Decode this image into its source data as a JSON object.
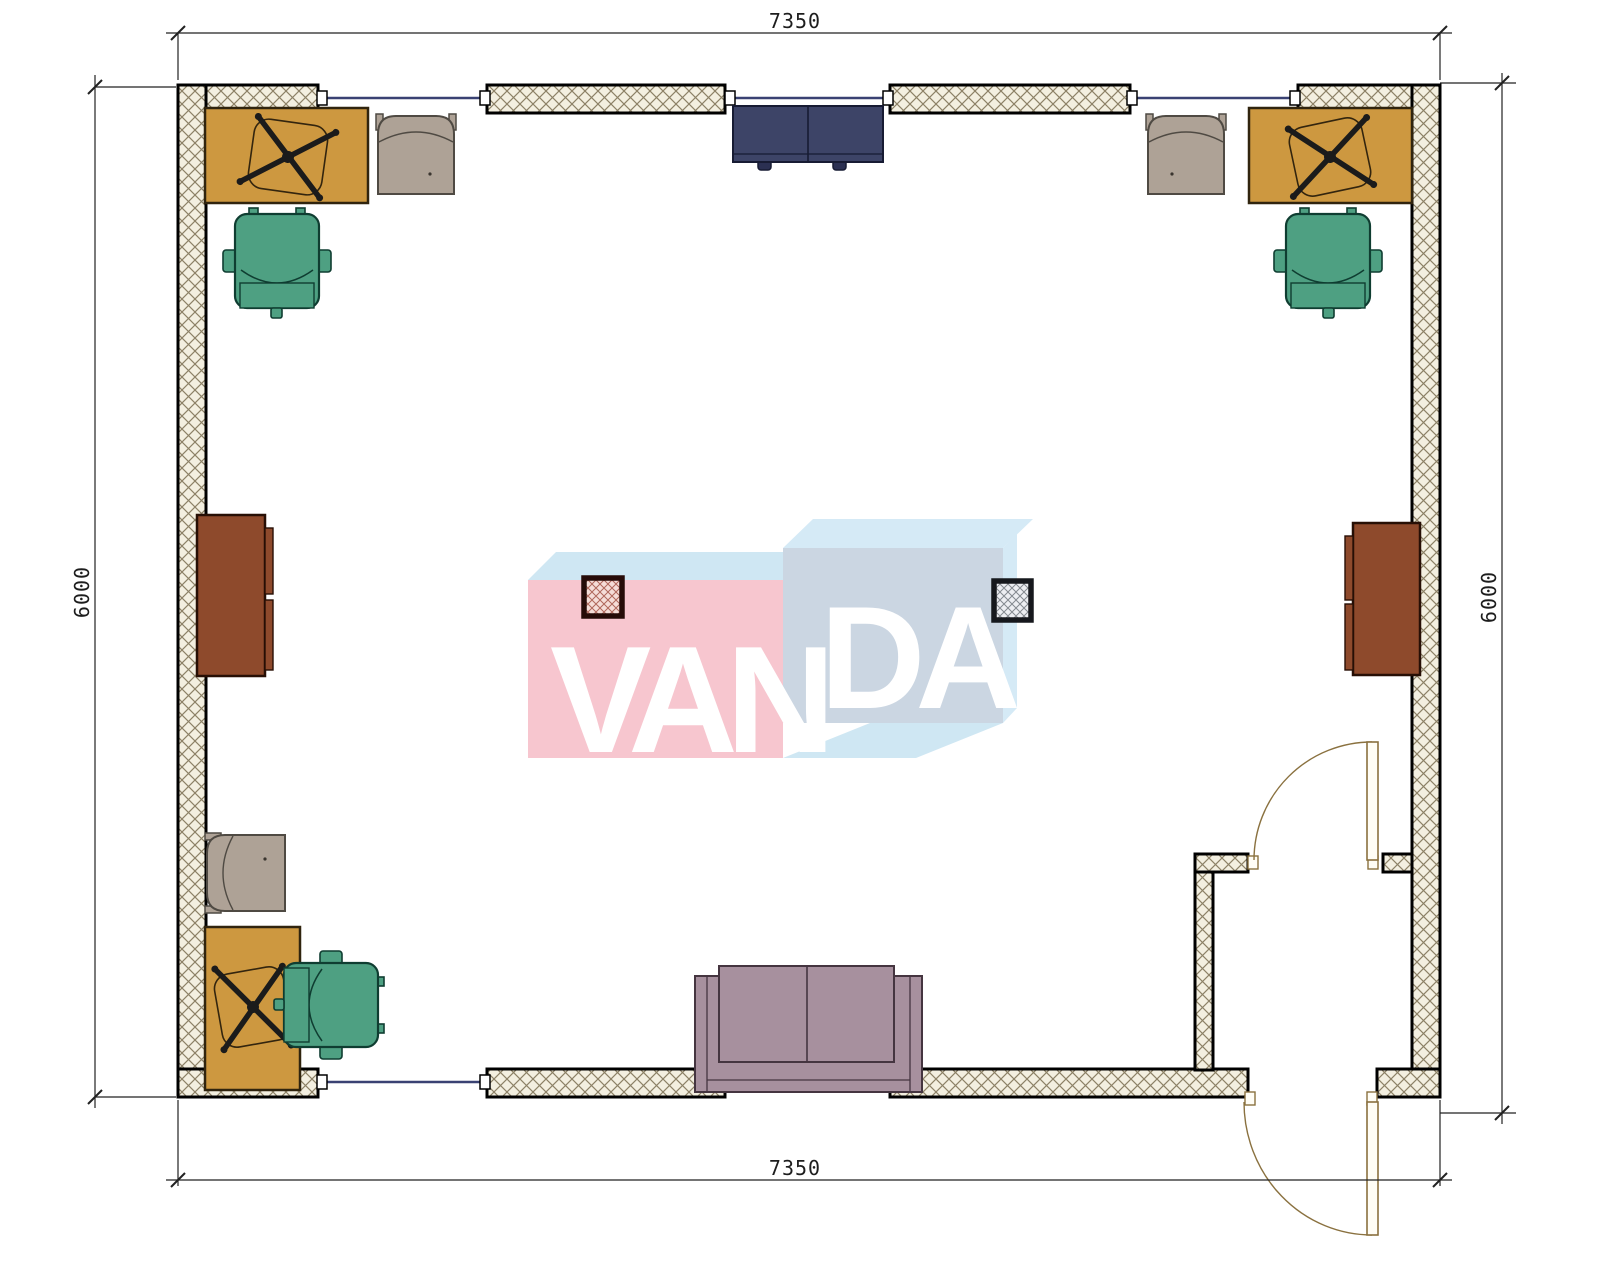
{
  "drawing": {
    "type": "floor-plan",
    "dimensions": {
      "top": "7350",
      "bottom": "7350",
      "left": "6000",
      "right": "6000"
    },
    "logo": {
      "name": "VANDA",
      "van": "VAN",
      "da": "DA"
    },
    "furniture": [
      "desk-top-left",
      "office-swivel-chair-top-left",
      "guest-chair-top-left",
      "task-chair-top-left",
      "desk-top-right",
      "office-swivel-chair-top-right",
      "guest-chair-top-right",
      "task-chair-top-right",
      "loveseat-top",
      "cabinet-left",
      "cabinet-right",
      "column-pink",
      "column-gray",
      "guest-chair-bottom-left",
      "desk-bottom-left",
      "office-swivel-chair-bottom-left",
      "task-chair-bottom-left",
      "sofa-bottom",
      "interior-door",
      "entry-door"
    ],
    "colors": {
      "wall_fill": "#F3EFE0",
      "wall_hatch": "#8C8166",
      "wall_border": "#000000",
      "window_glass": "#3A4273",
      "door_line": "#8A713F",
      "desk": "#CD9840",
      "chair_green": "#4EA082",
      "chair_beige": "#AEA296",
      "sofa_navy": "#3D4467",
      "sofa_mauve": "#A7909E",
      "cabinet_brown": "#8E4A2C",
      "column_pink": "#F5DDD8",
      "column_gray": "#EDEEF2",
      "logo_pink": "#F7C6CF",
      "logo_blue": "#CFE7F3",
      "logo_gray_blue": "#CBD6E2",
      "logo_pale_blue": "#D5EAF6",
      "dimension_line": "#222222"
    }
  }
}
